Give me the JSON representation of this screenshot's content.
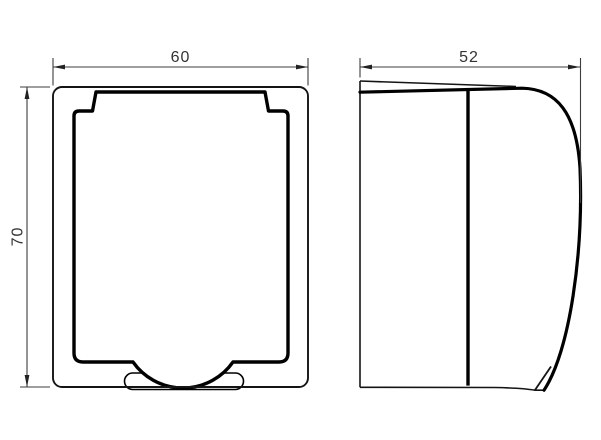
{
  "page": {
    "background_color": "#ffffff"
  },
  "drawing": {
    "kind": "technical-orthographic-drawing",
    "subject": "splash-proof socket cover, front view and side view",
    "outline_color": "#000000",
    "thin_line_color": "#141414",
    "dimension_line_color": "#3c3c3c",
    "dimension_text_color": "#333333",
    "dimensions": {
      "front_width": "60",
      "front_height": "70",
      "side_depth": "52"
    }
  }
}
